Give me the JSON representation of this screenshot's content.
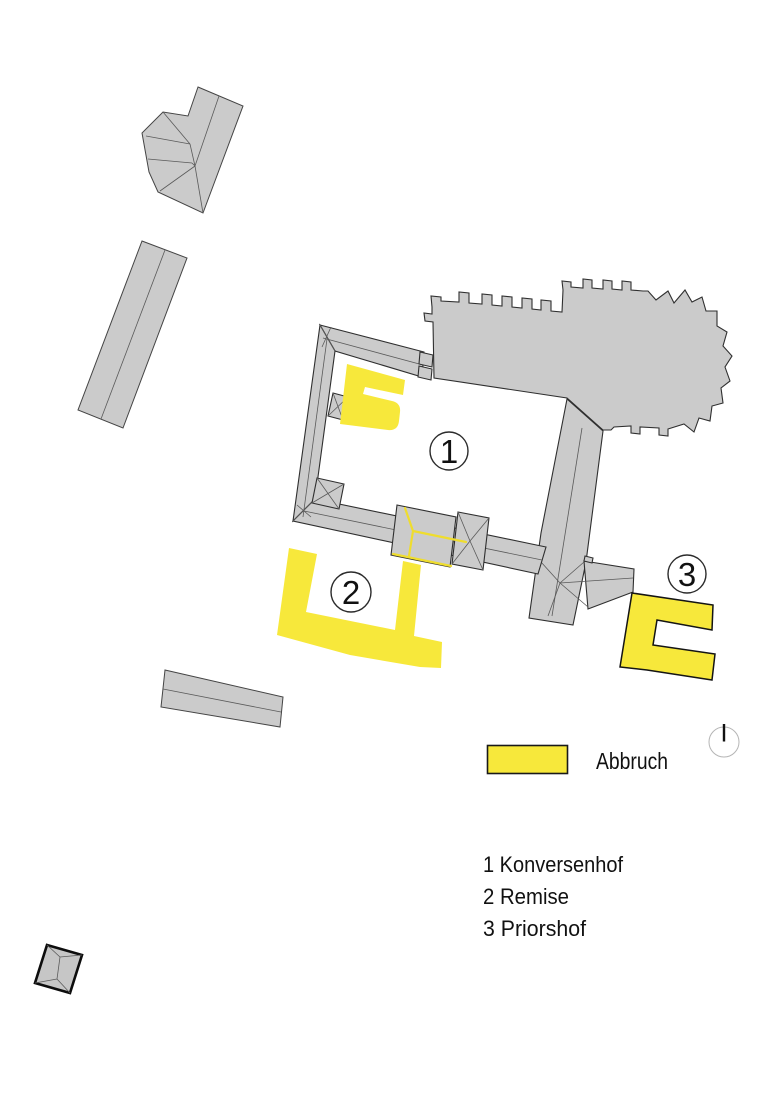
{
  "plan": {
    "markers": [
      {
        "label": "1"
      },
      {
        "label": "2"
      },
      {
        "label": "3"
      }
    ],
    "legend": {
      "label": "Abbruch",
      "swatch_meaning": "demolition"
    },
    "key": {
      "items": [
        {
          "number": "1",
          "name": "Konversenhof",
          "text": "1 Konversenhof"
        },
        {
          "number": "2",
          "name": "Remise",
          "text": "2 Remise"
        },
        {
          "number": "3",
          "name": "Priorshof",
          "text": "3 Priorshof"
        }
      ]
    },
    "icons": {
      "north": "north-indicator-icon"
    },
    "colors": {
      "demolition_yellow": "#F7E83B",
      "building_gray": "#CBCBCB",
      "outline_black": "#1A1A1A"
    }
  }
}
